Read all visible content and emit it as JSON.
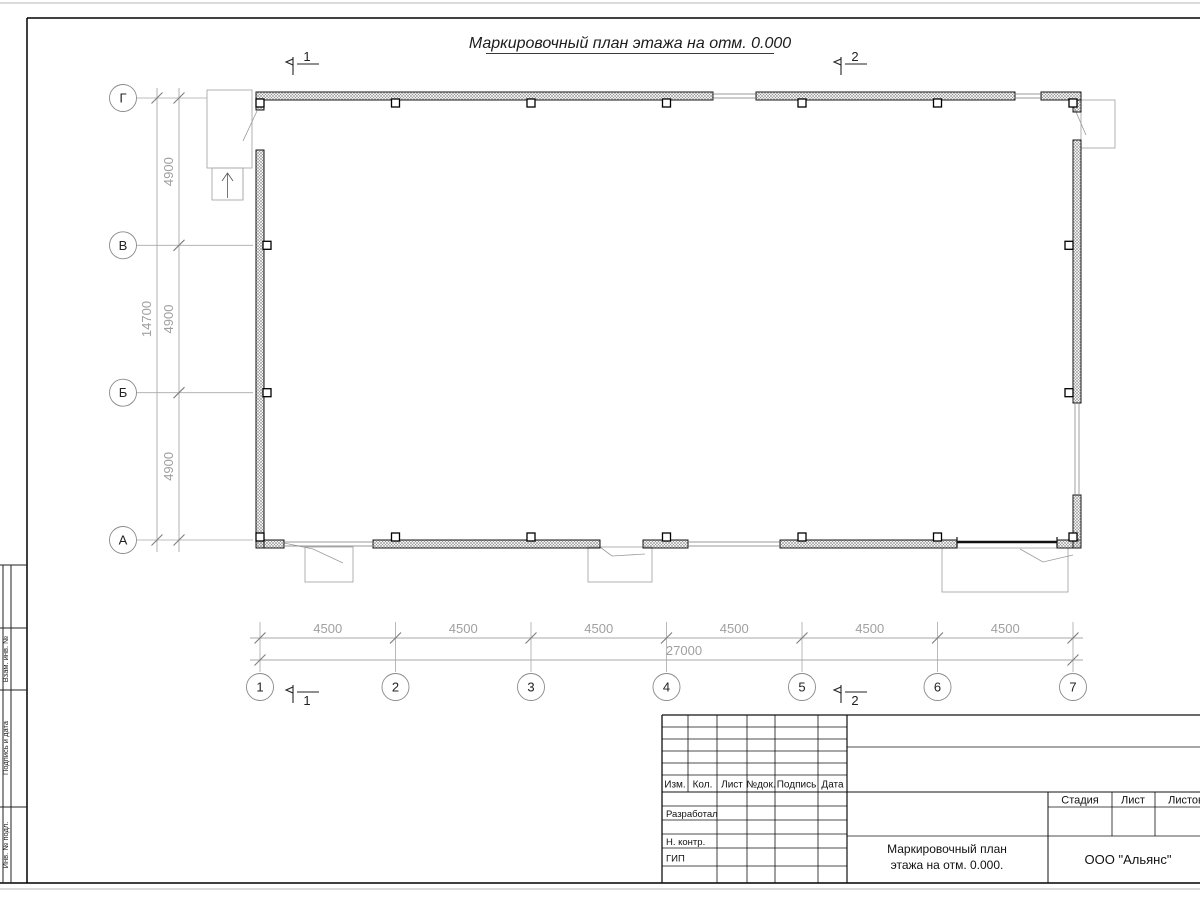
{
  "drawing": {
    "title": "Маркировочный план этажа на отм. 0.000",
    "axis_letters": [
      "Г",
      "В",
      "Б",
      "А"
    ],
    "axis_numbers": [
      "1",
      "2",
      "3",
      "4",
      "5",
      "6",
      "7"
    ],
    "dims_bottom_segments": [
      "4500",
      "4500",
      "4500",
      "4500",
      "4500",
      "4500"
    ],
    "dims_bottom_total": "27000",
    "dims_left_segments": [
      "4900",
      "4900",
      "4900"
    ],
    "dims_left_total": "14700",
    "section_mark_1": "1",
    "section_mark_2": "2"
  },
  "margin_column_labels": [
    "Взам. инв. №",
    "Подпись и дата",
    "Инв. № подл."
  ],
  "title_block": {
    "change_header": [
      "Изм.",
      "Кол.",
      "Лист",
      "№док.",
      "Подпись",
      "Дата"
    ],
    "role_rows": [
      "Разработал",
      "Н. контр.",
      "ГИП"
    ],
    "stage_header": [
      "Стадия",
      "Лист",
      "Листов"
    ],
    "doc_title_line1": "Маркировочный план",
    "doc_title_line2": "этажа на отм. 0.000.",
    "company": "ООО \"Альянс\""
  },
  "colors": {
    "line_dark": "#1c1c1c",
    "line_medium": "#555555",
    "line_light": "#a8a8a8",
    "leader": "#9b9b9b",
    "dim_text": "#a0a0a0",
    "hatch": "#8f8f8f",
    "paper_edge": "#b7b7b7",
    "axis_text": "#222222"
  }
}
